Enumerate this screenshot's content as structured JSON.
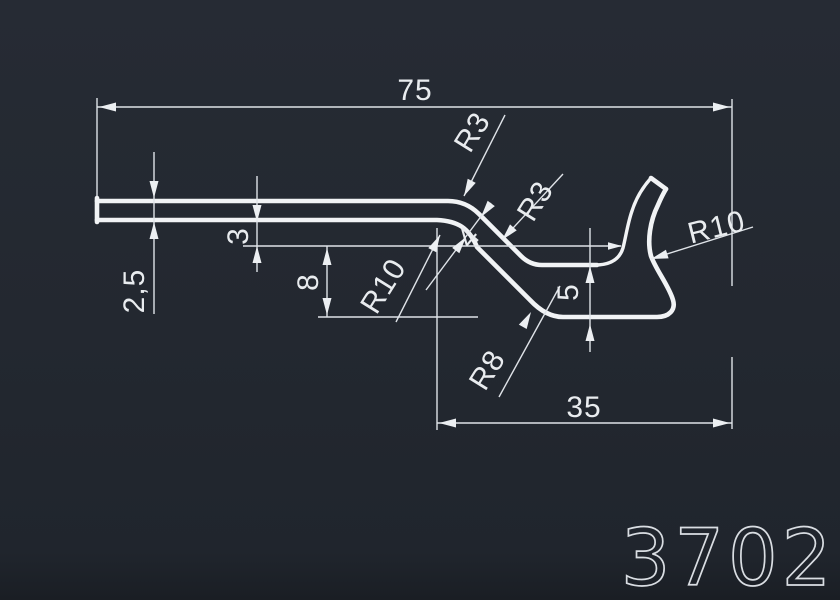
{
  "drawing": {
    "part_number": "3702",
    "dimensions": {
      "total_width": "75",
      "flange_width": "35",
      "strip_thickness": "2,5",
      "step_offset": "3",
      "channel_depth": "8",
      "diagonal_thickness": "4",
      "flange_height": "5"
    },
    "radii": {
      "top_bend": "R3",
      "mid_bend": "R3",
      "inner_bend": "R10",
      "hook_outer": "R10",
      "bottom_bend": "R8"
    },
    "colors": {
      "background": "#232830",
      "profile_line": "#f1f3f5",
      "dimension_line": "#dfe3e8",
      "text": "#e9ecef"
    }
  }
}
